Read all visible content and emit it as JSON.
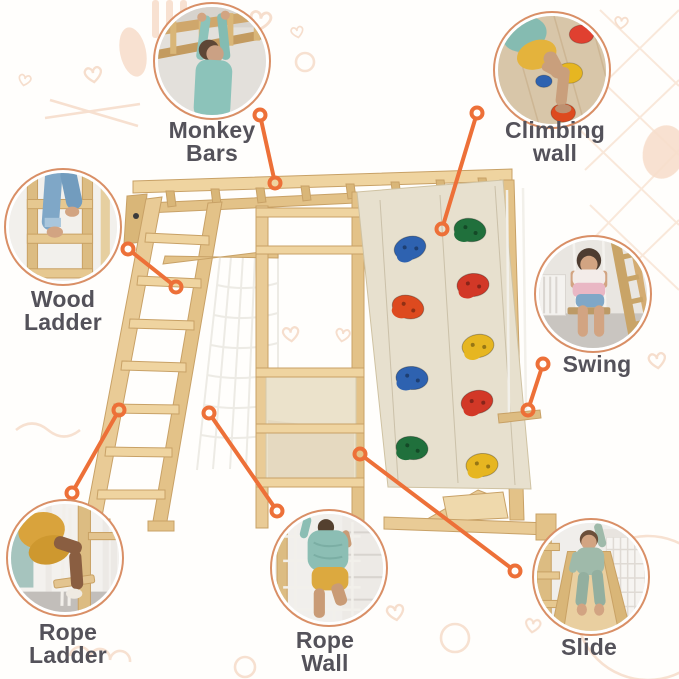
{
  "diagram": {
    "product": "wooden-climbing-frame-playset",
    "accent_color": "#ED7038",
    "circle_border_color": "#D98F66",
    "label_color": "#54525A",
    "climbing_hold_colors": [
      "#2E62B0",
      "#20703C",
      "#D23827",
      "#DD4A1F",
      "#E6B621"
    ],
    "features": [
      {
        "name": "monkey-bars",
        "label_line1": "Monkey",
        "label_line2": "Bars",
        "photo": "child-hanging-from-wooden-monkey-bars"
      },
      {
        "name": "climbing-wall",
        "label_line1": "Climbing",
        "label_line2": "wall",
        "photo": "child-climbing-wall-with-colorful-holds"
      },
      {
        "name": "wood-ladder",
        "label_line1": "Wood",
        "label_line2": "Ladder",
        "photo": "child-legs-stepping-up-wooden-ladder"
      },
      {
        "name": "swing",
        "label_line1": "Swing",
        "label_line2": "",
        "photo": "girl-sitting-on-rope-swing"
      },
      {
        "name": "rope-ladder",
        "label_line1": "Rope",
        "label_line2": "Ladder",
        "photo": "child-climbing-rope-ladder"
      },
      {
        "name": "rope-wall",
        "label_line1": "Rope",
        "label_line2": "Wall",
        "photo": "child-climbing-rope-net-wall"
      },
      {
        "name": "slide",
        "label_line1": "Slide",
        "label_line2": "",
        "photo": "child-sliding-down-wooden-slide"
      }
    ]
  }
}
